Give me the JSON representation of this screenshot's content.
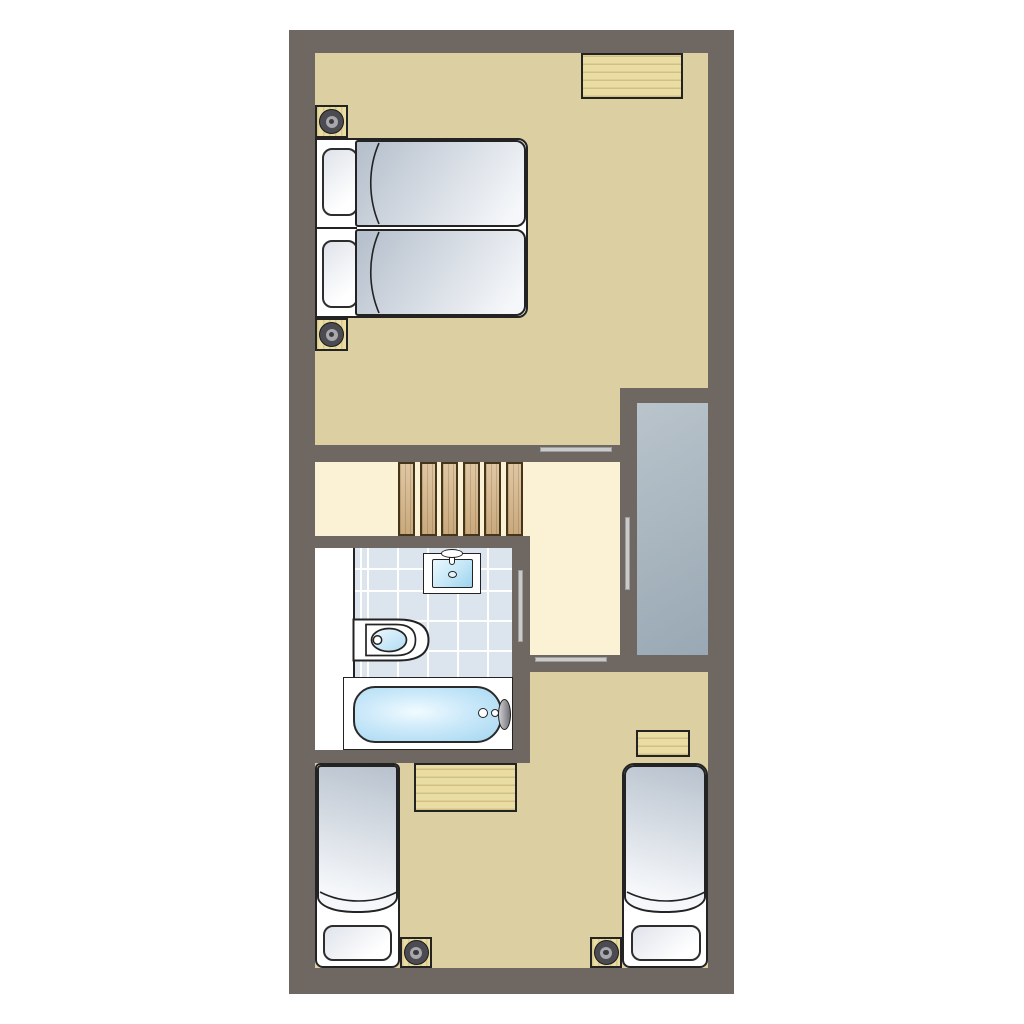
{
  "meta": {
    "kind": "architectural floor plan, top-down view",
    "storey": "upper floor of a two-bedroom holiday cottage",
    "visible_text": "none"
  },
  "palette": {
    "wall": "#6f6862",
    "tan": "#dccfa2",
    "cream": "#fbf2d6",
    "white": "#ffffff",
    "outline": "#232323",
    "tile": "#dce4ee",
    "grout": "#ffffff",
    "wood": "#eadda4",
    "stair": "#d5b486",
    "void-a": "#b9c4cb",
    "void-b": "#99a8b4",
    "duvet-a": "#b7c1cd",
    "duvet-b": "#f5f7fa",
    "pillow-a": "#dfe3ea",
    "bar": "#cacaca",
    "water-a": "#f1fbff",
    "water-b": "#a3d6f1",
    "basin-a": "#eaf8fe",
    "basin-b": "#9cd3ee",
    "ring-a": "#4b4b51",
    "ring-b": "#a8a8ac",
    "ring-c": "#3a3a40",
    "metal-a": "#d0d0d4",
    "metal-b": "#6f6f75"
  },
  "stairs": {
    "tread_count": 6
  },
  "labels": {
    "plan": "Upper floor plan",
    "top_bedroom": "Bedroom with double bed",
    "bottom_bedroom": "Bedroom with two single beds",
    "bathroom": "Bathroom",
    "landing": "Landing",
    "double_bed": "Double bed",
    "single_bed_left": "Single bed",
    "single_bed_right": "Single bed",
    "desk": "Desk",
    "small_table": "Side table",
    "bedside_table": "Bedside table with lamp",
    "stairs": "Staircase",
    "void": "Void / stairwell",
    "bath": "Bath",
    "washbasin": "Washbasin",
    "toilet": "Toilet",
    "door": "Door opening",
    "opening": "Interior window opening"
  }
}
